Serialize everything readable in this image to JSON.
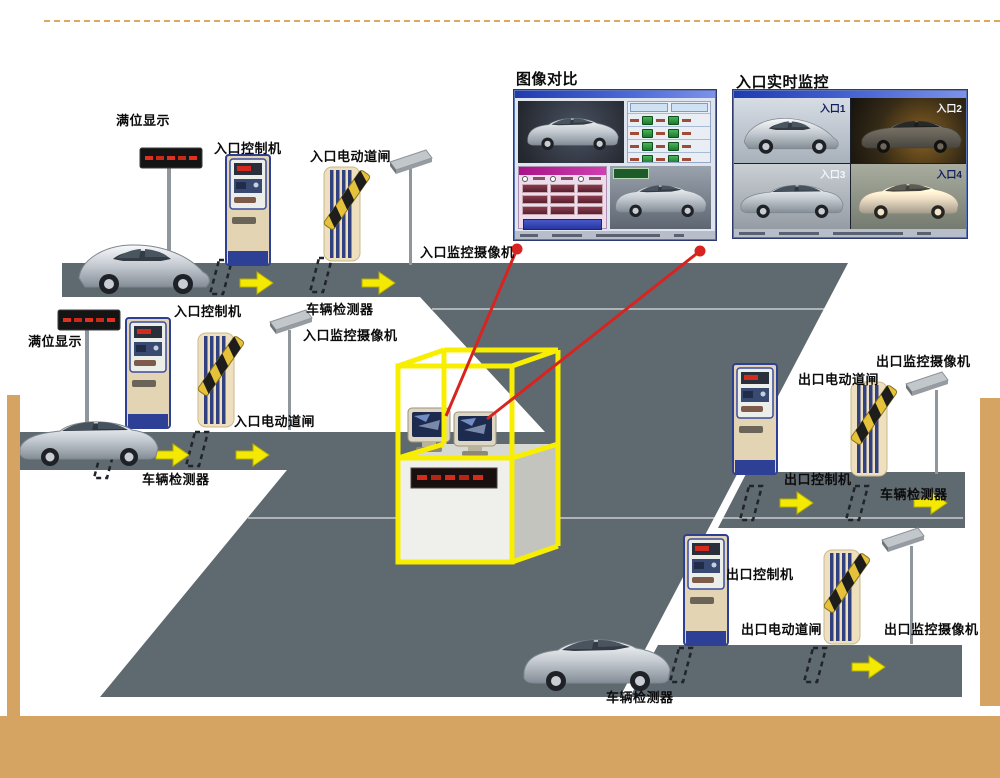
{
  "slide": {
    "top_dashed_line_color": "#dca95e",
    "accent_bar_color": "#d6a462",
    "background_color": "#ffffff"
  },
  "diagram": {
    "road_color": "#5f6970",
    "arrow_color": "#f3e903",
    "booth_frame_color": "#f8ef00",
    "link_line_color": "#d82420",
    "labels": {
      "full_display_1": "满位显示",
      "entrance_controller_1": "入口控制机",
      "entrance_barrier_1": "入口电动道闸",
      "entrance_camera_1": "入口监控摄像机",
      "vehicle_detector_1": "车辆检测器",
      "full_display_2": "满位显示",
      "entrance_controller_2": "入口控制机",
      "entrance_camera_2": "入口监控摄像机",
      "entrance_barrier_2": "入口电动道闸",
      "vehicle_detector_2": "车辆检测器",
      "exit_camera_1": "出口监控摄像机",
      "exit_barrier_1": "出口电动道闸",
      "exit_controller_1": "出口控制机",
      "vehicle_detector_3": "车辆检测器",
      "exit_controller_2": "出口控制机",
      "exit_barrier_2": "出口电动道闸",
      "exit_camera_2": "出口监控摄像机",
      "vehicle_detector_4": "车辆检测器"
    },
    "screens": {
      "compare": {
        "title": "图像对比"
      },
      "monitor": {
        "title": "入口实时监控",
        "cells": [
          "入口1",
          "入口2",
          "入口3",
          "入口4"
        ]
      }
    }
  }
}
